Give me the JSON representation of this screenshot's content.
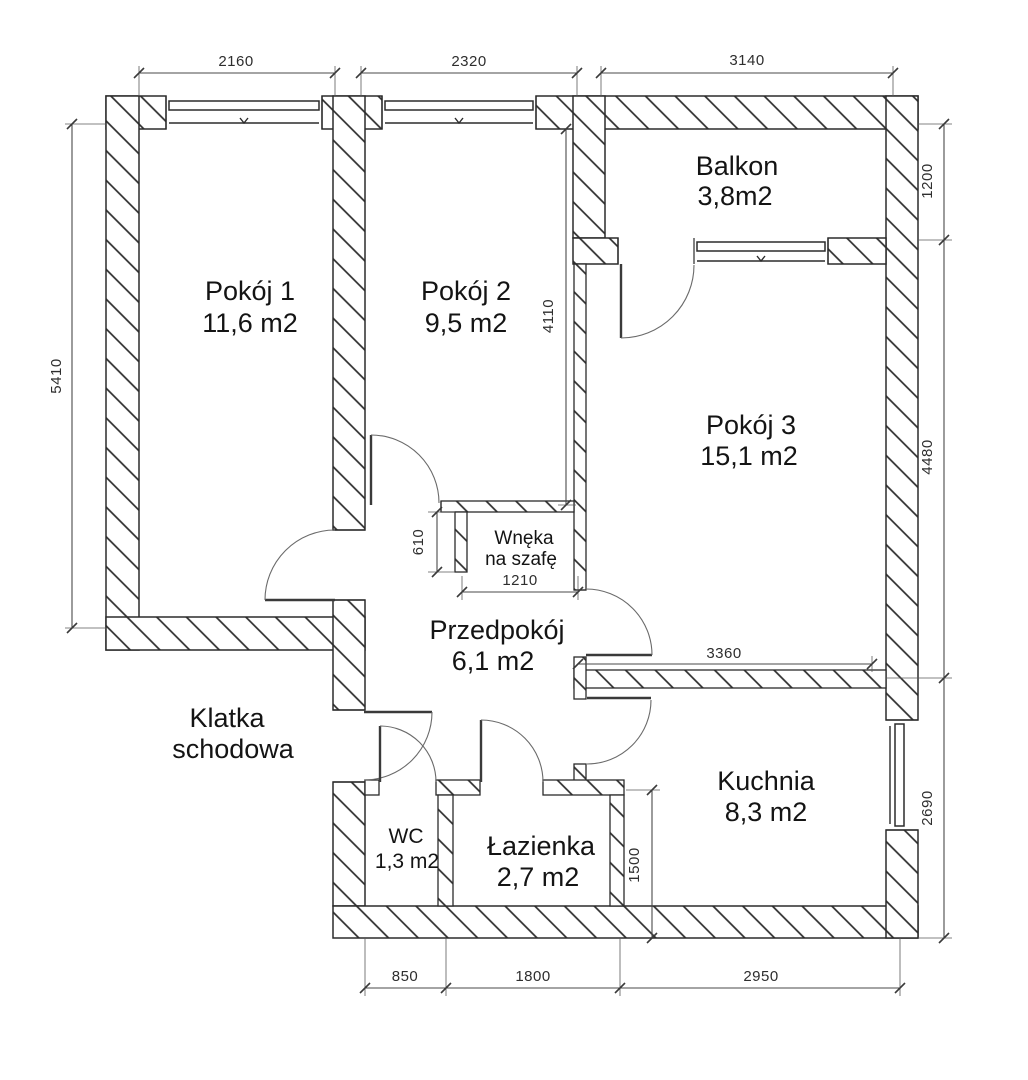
{
  "plan": {
    "colors": {
      "line": "#2b2b2b",
      "background": "#ffffff"
    },
    "rooms": {
      "pokoj1": {
        "name": "Pokój 1",
        "area": "11,6 m2"
      },
      "pokoj2": {
        "name": "Pokój 2",
        "area": "9,5 m2"
      },
      "balkon": {
        "name": "Balkon",
        "area": "3,8m2"
      },
      "pokoj3": {
        "name": "Pokój 3",
        "area": "15,1 m2"
      },
      "wneka": {
        "line1": "Wnęka",
        "line2": "na szafę"
      },
      "przedpokoj": {
        "name": "Przedpokój",
        "area": "6,1 m2"
      },
      "klatka": {
        "line1": "Klatka",
        "line2": "schodowa"
      },
      "wc": {
        "name": "WC",
        "area": "1,3 m2"
      },
      "lazienka": {
        "name": "Łazienka",
        "area": "2,7 m2"
      },
      "kuchnia": {
        "name": "Kuchnia",
        "area": "8,3 m2"
      }
    },
    "dims": {
      "top_pokoj1": "2160",
      "top_pokoj2": "2320",
      "top_balkon": "3140",
      "left_height": "5410",
      "right_balkon": "1200",
      "right_pokoj3": "4480",
      "right_kuchnia": "2690",
      "bottom_wc": "850",
      "bottom_lazienka": "1800",
      "bottom_kuchnia": "2950",
      "pokoj2_height": "4110",
      "wneka_depth": "610",
      "wneka_width": "1210",
      "wall_pokoj3_kuchnia": "3360",
      "lazienka_height": "1500"
    }
  }
}
